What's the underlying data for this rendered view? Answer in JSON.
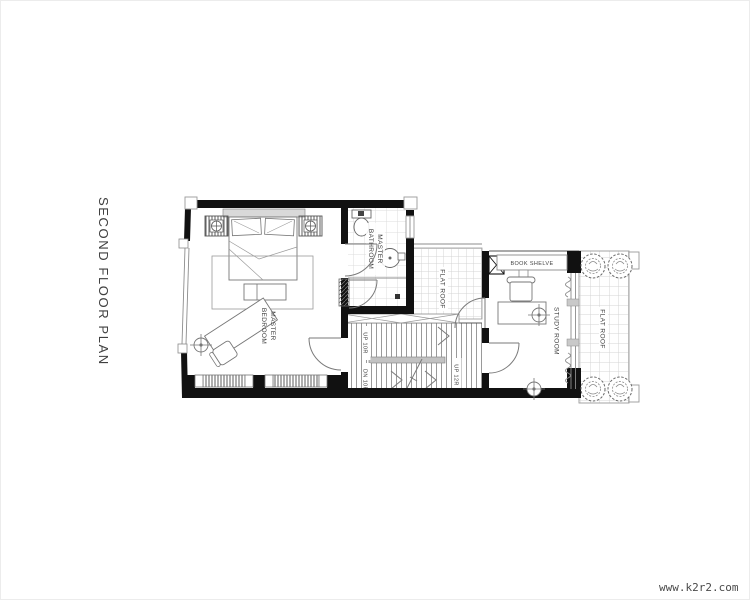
{
  "page": {
    "title": "SECOND FLOOR PLAN",
    "watermark": "www.k2r2.com"
  },
  "plan": {
    "rooms": {
      "master_bedroom": {
        "line1": "MASTER",
        "line2": "BEDROOM"
      },
      "master_bathroom": {
        "line1": "MASTER",
        "line2": "BATHROOM"
      },
      "study_room": {
        "label": "STUDY ROOM"
      },
      "flat_roof_mid": {
        "label": "FLAT ROOF"
      },
      "flat_roof_right": {
        "label": "FLAT ROOF"
      },
      "book_shelve": {
        "label": "BOOK SHELVE"
      }
    },
    "stairs": {
      "up_left": "UP 10R",
      "down_left": "DN 10R",
      "up_right": "UP 12R"
    },
    "colors": {
      "wall": "#111111",
      "line": "#8c8c8c",
      "grid": "#d9d9d9",
      "text": "#3f3f3f"
    }
  }
}
